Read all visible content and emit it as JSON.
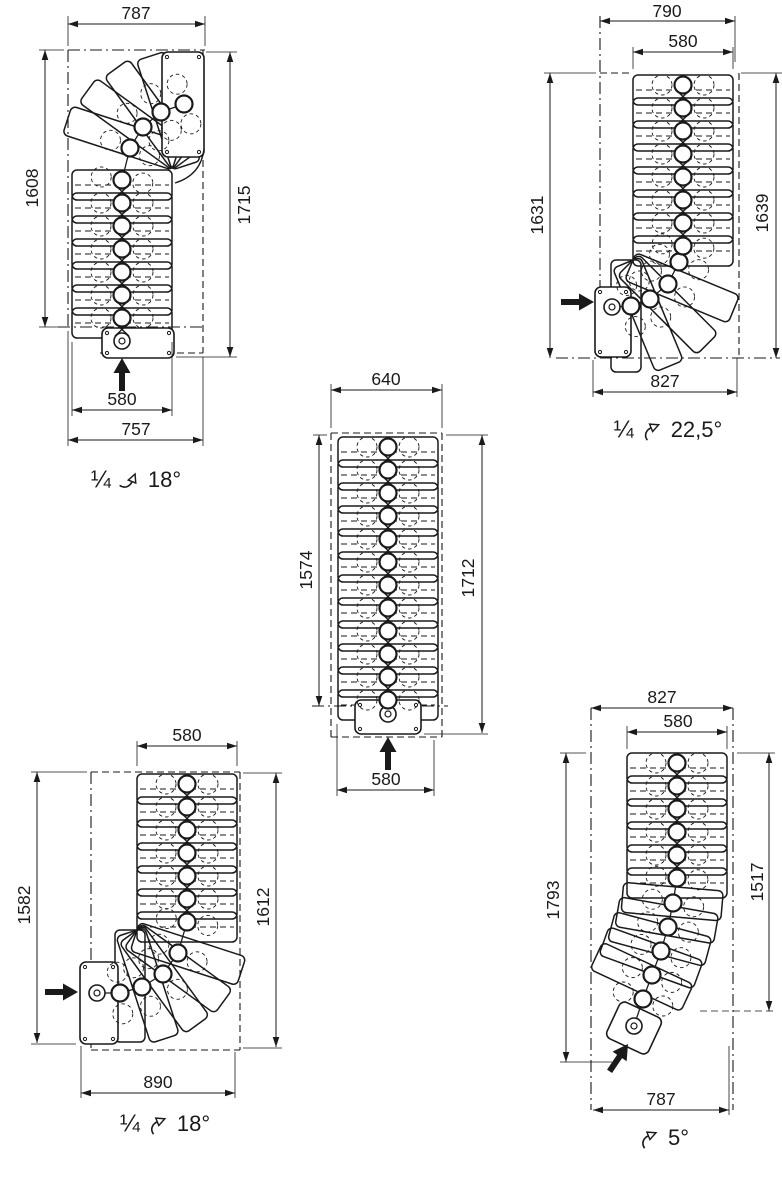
{
  "sheet": {
    "background": "#ffffff",
    "line_color": "#1a1a1a"
  },
  "diagrams": [
    {
      "id": "quarter-turn-top-18",
      "position": "top-left",
      "entry_icon": "entry-arrow-up-icon",
      "dims": {
        "top": "787",
        "left": "1608",
        "right": "1715",
        "width": "580",
        "bottom": "757"
      },
      "caption": {
        "fraction": "¼",
        "icon": "quarter-turn-right-arrow-icon",
        "angle": "18°"
      }
    },
    {
      "id": "quarter-turn-bottom-22-5",
      "position": "top-right",
      "entry_icon": "entry-arrow-right-icon",
      "dims": {
        "top": "790",
        "width": "580",
        "left": "1631",
        "right": "1639",
        "bottom": "827"
      },
      "caption": {
        "fraction": "¼",
        "icon": "quarter-turn-left-arrow-icon",
        "angle": "22,5°"
      }
    },
    {
      "id": "straight-flight",
      "position": "center",
      "entry_icon": "entry-arrow-up-icon",
      "dims": {
        "top": "640",
        "left": "1574",
        "right": "1712",
        "bottom": "580"
      },
      "caption": null
    },
    {
      "id": "quarter-turn-bottom-18",
      "position": "bottom-left",
      "entry_icon": "entry-arrow-right-icon",
      "dims": {
        "top": "580",
        "left": "1582",
        "right": "1612",
        "bottom": "890"
      },
      "caption": {
        "fraction": "¼",
        "icon": "quarter-turn-left-arrow-icon",
        "angle": "18°"
      }
    },
    {
      "id": "curved-flight-5",
      "position": "bottom-right",
      "entry_icon": "entry-arrow-up-right-icon",
      "dims": {
        "top": "827",
        "width": "580",
        "left": "1793",
        "right": "1517",
        "bottom": "787"
      },
      "caption": {
        "fraction": "",
        "icon": "turn-left-arrow-icon",
        "angle": "5°"
      }
    }
  ]
}
